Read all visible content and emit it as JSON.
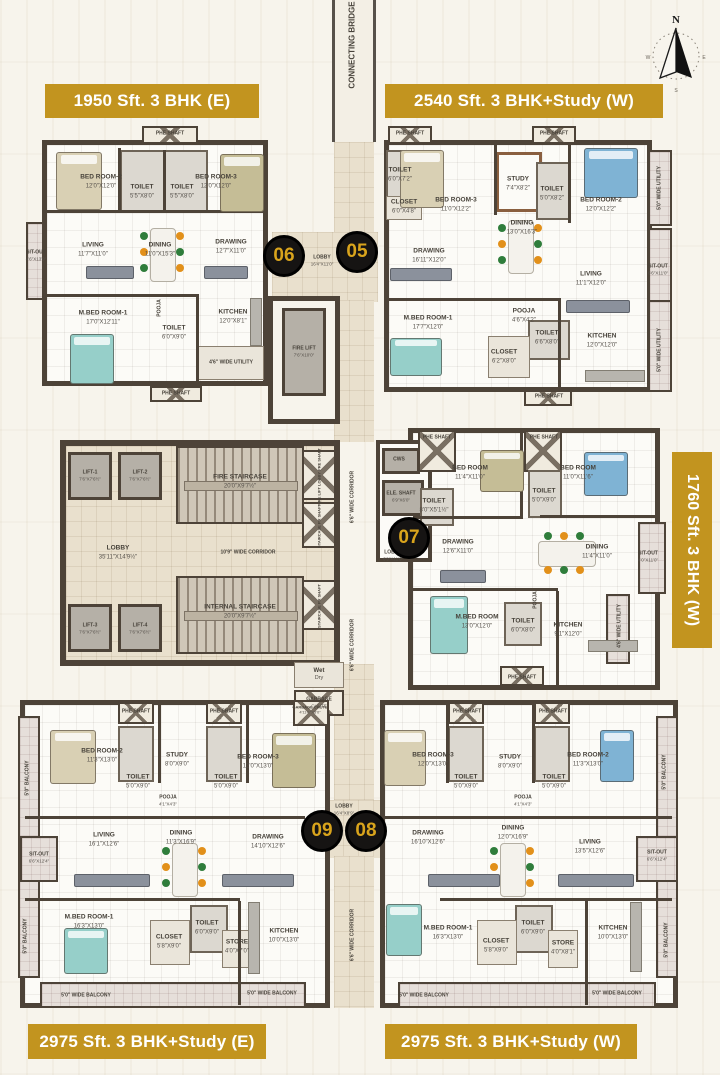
{
  "palette": {
    "gold": "#c2941f",
    "bg": "#f7f4ec",
    "wall": "#4d4338",
    "floor": "#fcfbf7",
    "lobbyFloor": "#e9e0cd",
    "stairFloor": "#cfc7b8",
    "liftFloor": "#b5b0a7",
    "balconyFloor": "#e6dfda",
    "badgeBg": "#161413",
    "badgeText": "#d9a41c",
    "teal": "#96cfc9",
    "blue": "#7fb3d4",
    "beige": "#d9d0b4",
    "olive": "#c5bd96",
    "sofa": "#8b919c",
    "greenChair": "#2f7d3b",
    "orangeChair": "#e2901a"
  },
  "banners": {
    "top_left": "1950 Sft. 3 BHK (E)",
    "top_right": "2540 Sft. 3 BHK+Study (W)",
    "right_vertical": "1760 Sft. 3 BHK (W)",
    "bottom_left": "2975 Sft. 3 BHK+Study (E)",
    "bottom_right": "2975 Sft. 3 BHK+Study (W)"
  },
  "compass": {
    "n": "N",
    "w": "W",
    "e": "E",
    "s": "S"
  },
  "unit_markers": [
    {
      "num": "06",
      "x": 284,
      "y": 256
    },
    {
      "num": "05",
      "x": 357,
      "y": 252
    },
    {
      "num": "07",
      "x": 409,
      "y": 538
    },
    {
      "num": "09",
      "x": 322,
      "y": 831
    },
    {
      "num": "08",
      "x": 366,
      "y": 831
    }
  ],
  "room_labels": [
    {
      "t": "CONNECTING BRIDGE",
      "x": 353,
      "y": 45,
      "v": 1,
      "s": 8
    },
    {
      "t": "PHE SHAFT",
      "x": 170,
      "y": 134,
      "s": 5
    },
    {
      "t": "BED ROOM-2",
      "d": "12'0\"X12'0\"",
      "x": 101,
      "y": 182
    },
    {
      "t": "TOILET",
      "d": "5'5\"X8'0\"",
      "x": 142,
      "y": 192
    },
    {
      "t": "TOILET",
      "d": "5'5\"X8'0\"",
      "x": 182,
      "y": 192
    },
    {
      "t": "BED ROOM-3",
      "d": "12'0\"X12'0\"",
      "x": 216,
      "y": 182
    },
    {
      "t": "LIVING",
      "d": "11'7\"X11'0\"",
      "x": 93,
      "y": 250
    },
    {
      "t": "DINING",
      "d": "11'0\"X15'3\"",
      "x": 160,
      "y": 250
    },
    {
      "t": "DRAWING",
      "d": "12'7\"X11'0\"",
      "x": 231,
      "y": 247
    },
    {
      "t": "SIT-OUT",
      "d": "4'6\"X13'9\"",
      "x": 36,
      "y": 256,
      "s": 5
    },
    {
      "t": "M.BED ROOM-1",
      "d": "17'0\"X12'11\"",
      "x": 103,
      "y": 318
    },
    {
      "t": "POOJA",
      "x": 160,
      "y": 308,
      "v": 1,
      "s": 5
    },
    {
      "t": "TOILET",
      "d": "6'0\"X9'0\"",
      "x": 174,
      "y": 333
    },
    {
      "t": "KITCHEN",
      "d": "12'0\"X8'1\"",
      "x": 233,
      "y": 317
    },
    {
      "t": "4'6\" WIDE UTILITY",
      "x": 231,
      "y": 363,
      "s": 5
    },
    {
      "t": "PHE SHAFT",
      "x": 176,
      "y": 394,
      "s": 5
    },
    {
      "t": "PHE SHAFT",
      "x": 410,
      "y": 134,
      "s": 5
    },
    {
      "t": "PHE SHAFT",
      "x": 554,
      "y": 134,
      "s": 5
    },
    {
      "t": "TOILET",
      "d": "6'0\"X7'2\"",
      "x": 400,
      "y": 175
    },
    {
      "t": "CLOSET",
      "d": "6'0\"X4'8\"",
      "x": 404,
      "y": 207
    },
    {
      "t": "BED ROOM-3",
      "d": "11'0\"X12'2\"",
      "x": 456,
      "y": 205
    },
    {
      "t": "STUDY",
      "d": "7'4\"X8'2\"",
      "x": 518,
      "y": 184
    },
    {
      "t": "TOILET",
      "d": "5'0\"X8'2\"",
      "x": 552,
      "y": 194
    },
    {
      "t": "BED ROOM-2",
      "d": "12'0\"X12'2\"",
      "x": 601,
      "y": 205
    },
    {
      "t": "5'0\" WIDE UTILITY",
      "x": 660,
      "y": 188,
      "v": 1,
      "s": 5
    },
    {
      "t": "DINING",
      "d": "13'0\"X16'3\"",
      "x": 522,
      "y": 228
    },
    {
      "t": "DRAWING",
      "d": "16'11\"X12'0\"",
      "x": 429,
      "y": 256
    },
    {
      "t": "LIVING",
      "d": "11'1\"X12'0\"",
      "x": 591,
      "y": 279
    },
    {
      "t": "SIT-OUT",
      "d": "6'6\"X11'0\"",
      "x": 658,
      "y": 270,
      "s": 5
    },
    {
      "t": "M.BED ROOM-1",
      "d": "17'7\"X12'0\"",
      "x": 428,
      "y": 323
    },
    {
      "t": "POOJA",
      "d": "4'6\"X4'2\"",
      "x": 524,
      "y": 316
    },
    {
      "t": "TOILET",
      "d": "6'6\"X8'0\"",
      "x": 547,
      "y": 338
    },
    {
      "t": "CLOSET",
      "d": "6'2\"X8'0\"",
      "x": 504,
      "y": 357
    },
    {
      "t": "KITCHEN",
      "d": "12'0\"X12'0\"",
      "x": 602,
      "y": 341
    },
    {
      "t": "5'0\" WIDE UTILITY",
      "x": 660,
      "y": 350,
      "v": 1,
      "s": 5
    },
    {
      "t": "PHE SHAFT",
      "x": 549,
      "y": 397,
      "s": 5
    },
    {
      "t": "LOBBY",
      "d": "16'4\"X11'0\"",
      "x": 322,
      "y": 261,
      "s": 5
    },
    {
      "t": "FIRE LIFT",
      "d": "7'6\"X10'0\"",
      "x": 304,
      "y": 352,
      "s": 5
    },
    {
      "t": "LIFT-1",
      "d": "7'6\"X7'6½\"",
      "x": 90,
      "y": 476,
      "s": 5
    },
    {
      "t": "LIFT-2",
      "d": "7'6\"X7'6½\"",
      "x": 140,
      "y": 476,
      "s": 5
    },
    {
      "t": "FIRE STAIRCASE",
      "d": "20'0\"X9'7½\"",
      "x": 240,
      "y": 482
    },
    {
      "t": "FIRE LIFT LOBBY PRE SHAFT",
      "x": 319,
      "y": 477,
      "v": 1,
      "s": 4
    },
    {
      "t": "STAIRCASE PR SHAFT",
      "x": 319,
      "y": 526,
      "v": 1,
      "s": 4
    },
    {
      "t": "LOBBY",
      "d": "35'11\"X14'9½\"",
      "x": 118,
      "y": 553
    },
    {
      "t": "10'9\" WIDE CORRIDOR",
      "x": 248,
      "y": 553,
      "s": 5
    },
    {
      "t": "LIFT-3",
      "d": "7'6\"X7'6½\"",
      "x": 90,
      "y": 629,
      "s": 5
    },
    {
      "t": "LIFT-4",
      "d": "7'6\"X7'6½\"",
      "x": 140,
      "y": 629,
      "s": 5
    },
    {
      "t": "INTERNAL STAIRCASE",
      "d": "20'0\"X9'7½\"",
      "x": 240,
      "y": 612
    },
    {
      "t": "STAIRCASE PR SHAFT",
      "x": 319,
      "y": 606,
      "v": 1,
      "s": 4
    },
    {
      "t": "Wet",
      "d": "Dry",
      "x": 319,
      "y": 675,
      "s": 6
    },
    {
      "t": "GARBAGE",
      "d": "CHUTE",
      "x": 319,
      "y": 703,
      "s": 5
    },
    {
      "t": "6'6\" WIDE CORRIDOR",
      "x": 353,
      "y": 497,
      "v": 1,
      "s": 5
    },
    {
      "t": "6'6\" WIDE CORRIDOR",
      "x": 353,
      "y": 645,
      "v": 1,
      "s": 5
    },
    {
      "t": "6'6\" WIDE CORRIDOR",
      "x": 353,
      "y": 935,
      "v": 1,
      "s": 5
    },
    {
      "t": "LOBBY",
      "d": "16'4\"X8'9\"",
      "x": 344,
      "y": 810,
      "s": 5
    },
    {
      "t": "PHE SHAFT",
      "x": 437,
      "y": 438,
      "s": 5
    },
    {
      "t": "PHE SHAFT",
      "x": 544,
      "y": 438,
      "s": 5
    },
    {
      "t": "CWS",
      "x": 399,
      "y": 460,
      "s": 5
    },
    {
      "t": "ELE. SHAFT",
      "d": "6'9\"X6'0\"",
      "x": 401,
      "y": 497,
      "s": 5
    },
    {
      "t": "BED ROOM",
      "d": "11'4\"X11'0\"",
      "x": 470,
      "y": 473
    },
    {
      "t": "BED ROOM",
      "d": "11'0\"X11'6\"",
      "x": 578,
      "y": 473
    },
    {
      "t": "TOILET",
      "d": "8'0\"X5'1½\"",
      "x": 434,
      "y": 506
    },
    {
      "t": "TOILET",
      "d": "5'0\"X9'0\"",
      "x": 544,
      "y": 496
    },
    {
      "t": "LOBBY",
      "d": "6'9\"X11'0\"",
      "x": 393,
      "y": 556,
      "s": 5
    },
    {
      "t": "DRAWING",
      "d": "12'6\"X11'0\"",
      "x": 458,
      "y": 547
    },
    {
      "t": "DINING",
      "d": "11'4\"X11'0\"",
      "x": 597,
      "y": 552
    },
    {
      "t": "SIT-OUT",
      "d": "4'0\"X11'0\"",
      "x": 648,
      "y": 557,
      "s": 5
    },
    {
      "t": "M.BED ROOM",
      "d": "13'0\"X12'0\"",
      "x": 477,
      "y": 622
    },
    {
      "t": "POOJA",
      "x": 536,
      "y": 600,
      "v": 1,
      "s": 5
    },
    {
      "t": "TOILET",
      "d": "6'0\"X8'0\"",
      "x": 523,
      "y": 626
    },
    {
      "t": "KITCHEN",
      "d": "9'1\"X12'0\"",
      "x": 568,
      "y": 630
    },
    {
      "t": "4'6\" WIDE UTILITY",
      "x": 620,
      "y": 626,
      "v": 1,
      "s": 5
    },
    {
      "t": "PHE SHAFT",
      "x": 522,
      "y": 678,
      "s": 5
    },
    {
      "t": "PHE SHAFT",
      "x": 136,
      "y": 712,
      "s": 5
    },
    {
      "t": "PHE SHAFT",
      "x": 224,
      "y": 712,
      "s": 5
    },
    {
      "t": "GARBAGE CHUTE",
      "d": "4'11½\"X3'0\"",
      "x": 310,
      "y": 710,
      "s": 4
    },
    {
      "t": "BED ROOM-2",
      "d": "11'3\"X13'0\"",
      "x": 102,
      "y": 756
    },
    {
      "t": "STUDY",
      "d": "8'0\"X9'0\"",
      "x": 177,
      "y": 760
    },
    {
      "t": "TOILET",
      "d": "5'0\"X9'0\"",
      "x": 138,
      "y": 782
    },
    {
      "t": "TOILET",
      "d": "5'0\"X9'0\"",
      "x": 226,
      "y": 782
    },
    {
      "t": "BED ROOM-3",
      "d": "12'0\"X13'0\"",
      "x": 258,
      "y": 762
    },
    {
      "t": "POOJA",
      "d": "4'1\"X4'3\"",
      "x": 168,
      "y": 801,
      "s": 5
    },
    {
      "t": "5'0\" BALCONY",
      "x": 28,
      "y": 778,
      "v": 1,
      "s": 5
    },
    {
      "t": "LIVING",
      "d": "16'1\"X12'6\"",
      "x": 104,
      "y": 840
    },
    {
      "t": "DINING",
      "d": "11'3\"X16'9\"",
      "x": 181,
      "y": 838
    },
    {
      "t": "DRAWING",
      "d": "14'10\"X12'6\"",
      "x": 268,
      "y": 842
    },
    {
      "t": "SIT-OUT",
      "d": "6'6\"X12'4\"",
      "x": 39,
      "y": 858,
      "s": 5
    },
    {
      "t": "M.BED ROOM-1",
      "d": "16'3\"X13'0\"",
      "x": 89,
      "y": 922
    },
    {
      "t": "CLOSET",
      "d": "5'8\"X9'0\"",
      "x": 169,
      "y": 942
    },
    {
      "t": "TOILET",
      "d": "6'0\"X9'0\"",
      "x": 207,
      "y": 928
    },
    {
      "t": "STORE",
      "d": "4'0\"X7'0\"",
      "x": 237,
      "y": 947
    },
    {
      "t": "KITCHEN",
      "d": "10'0\"X13'0\"",
      "x": 284,
      "y": 936
    },
    {
      "t": "5'0\" BALCONY",
      "x": 26,
      "y": 936,
      "v": 1,
      "s": 5
    },
    {
      "t": "5'0\" WIDE BALCONY",
      "x": 86,
      "y": 996,
      "s": 5
    },
    {
      "t": "5'0\" WIDE BALCONY",
      "x": 272,
      "y": 994,
      "s": 5
    },
    {
      "t": "PHE SHAFT",
      "x": 467,
      "y": 712,
      "s": 5
    },
    {
      "t": "PHE SHAFT",
      "x": 553,
      "y": 712,
      "s": 5
    },
    {
      "t": "BED ROOM-3",
      "d": "12'0\"X13'0\"",
      "x": 433,
      "y": 760
    },
    {
      "t": "STUDY",
      "d": "8'0\"X9'0\"",
      "x": 510,
      "y": 762
    },
    {
      "t": "TOILET",
      "d": "5'0\"X9'0\"",
      "x": 466,
      "y": 782
    },
    {
      "t": "TOILET",
      "d": "5'0\"X9'0\"",
      "x": 554,
      "y": 782
    },
    {
      "t": "BED ROOM-2",
      "d": "11'3\"X13'0\"",
      "x": 588,
      "y": 760
    },
    {
      "t": "POOJA",
      "d": "4'1\"X4'3\"",
      "x": 523,
      "y": 801,
      "s": 5
    },
    {
      "t": "5'0\" BALCONY",
      "x": 665,
      "y": 772,
      "v": 1,
      "s": 5
    },
    {
      "t": "DRAWING",
      "d": "16'10\"X12'6\"",
      "x": 428,
      "y": 838
    },
    {
      "t": "DINING",
      "d": "12'0\"X16'9\"",
      "x": 513,
      "y": 833
    },
    {
      "t": "LIVING",
      "d": "13'5\"X12'6\"",
      "x": 590,
      "y": 847
    },
    {
      "t": "SIT-OUT",
      "d": "6'6\"X12'4\"",
      "x": 657,
      "y": 856,
      "s": 5
    },
    {
      "t": "M.BED ROOM-1",
      "d": "16'3\"X13'0\"",
      "x": 448,
      "y": 933
    },
    {
      "t": "CLOSET",
      "d": "5'8\"X9'0\"",
      "x": 496,
      "y": 946
    },
    {
      "t": "TOILET",
      "d": "6'0\"X9'0\"",
      "x": 533,
      "y": 928
    },
    {
      "t": "STORE",
      "d": "4'0\"X8'1\"",
      "x": 563,
      "y": 948
    },
    {
      "t": "KITCHEN",
      "d": "10'0\"X13'0\"",
      "x": 613,
      "y": 933
    },
    {
      "t": "5'0\" BALCONY",
      "x": 667,
      "y": 940,
      "v": 1,
      "s": 5
    },
    {
      "t": "5'0\" WIDE BALCONY",
      "x": 424,
      "y": 996,
      "s": 5
    },
    {
      "t": "5'0\" WIDE BALCONY",
      "x": 617,
      "y": 994,
      "s": 5
    }
  ]
}
